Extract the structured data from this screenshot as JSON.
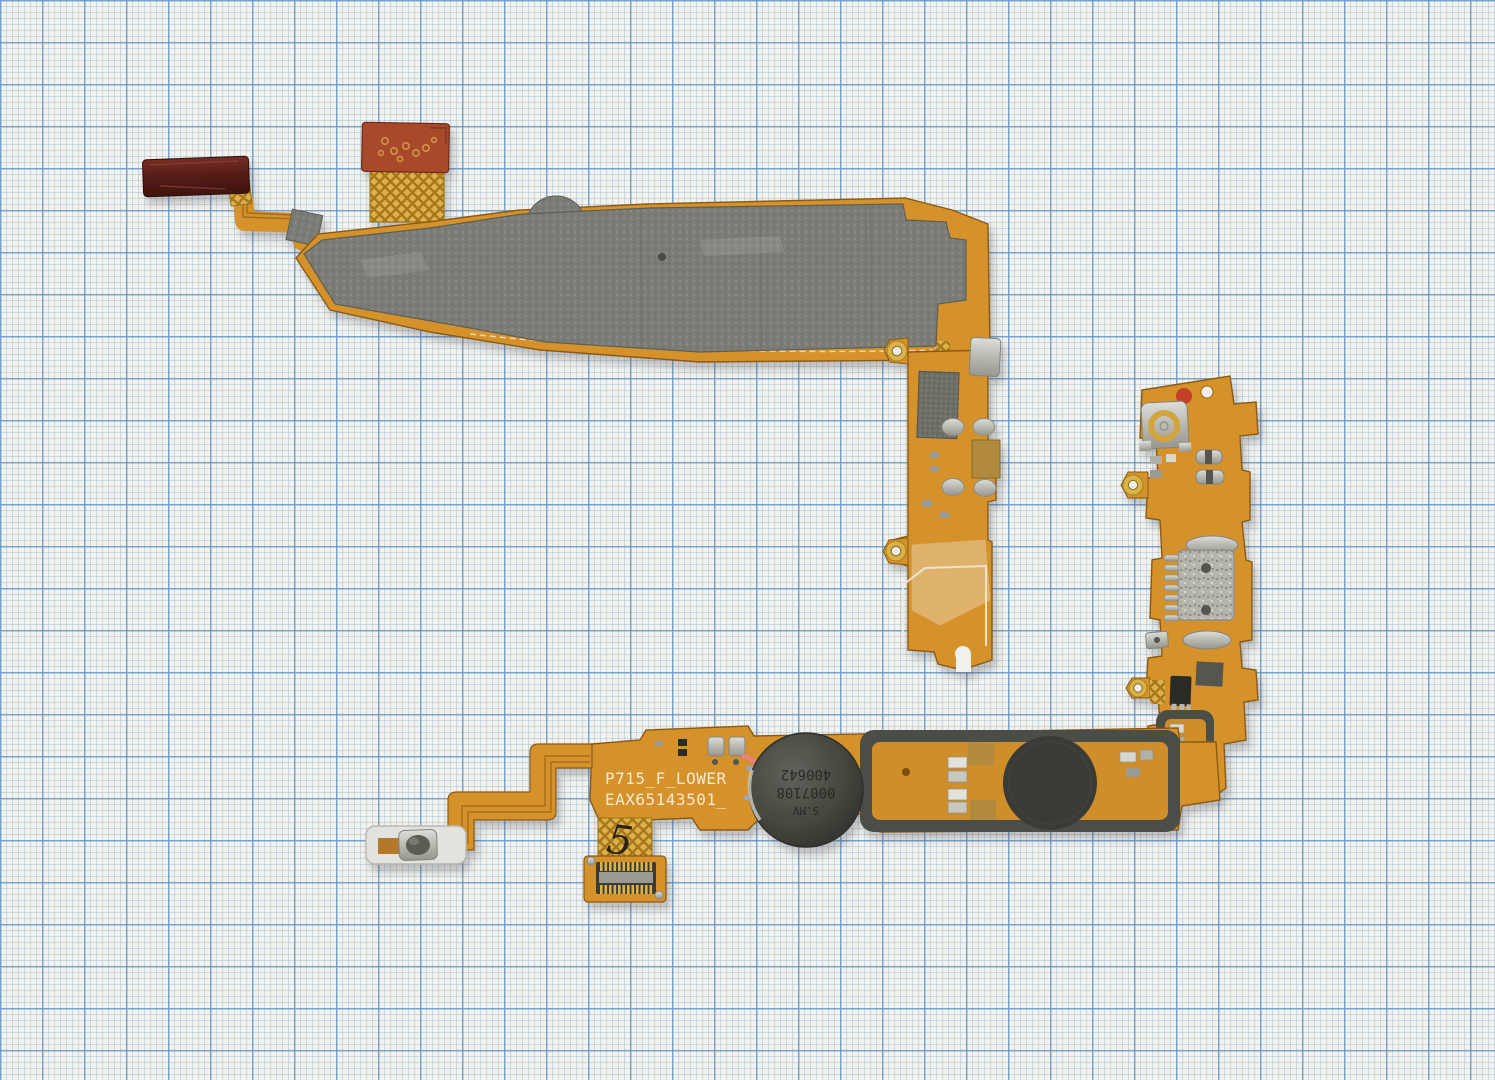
{
  "scene": {
    "background": "millimeter-graph-paper",
    "subject": "phone-lower-flex-cable-assembly-photo"
  },
  "texts": {
    "silkscreen_line1": "P715_F_LOWER",
    "silkscreen_line2": "EAX65143501_",
    "motor_line1": "S.MV",
    "motor_line2": "0007108",
    "motor_line3": "400642",
    "handwritten_mark": "5"
  },
  "parts": [
    "red-adhesive-tape-piece",
    "terracotta-flex-pad",
    "gold-crosshatch-flex",
    "emi-shield-fabric",
    "coax-antenna-connector",
    "micro-usb-connector",
    "vibration-motor",
    "speaker-contact-disc",
    "rubber-gasket-frame",
    "side-key-button-flex",
    "board-to-board-connector",
    "jumper-wires-pink-blue",
    "solder-domes",
    "gold-eyelets"
  ],
  "colors": {
    "paper": "#f4f2ec",
    "grid_minor": "#94b8d6",
    "grid_major": "#6496c6",
    "flex_orange": "#d6922c",
    "flex_dark": "#8a5a12",
    "gold_lattice": "#ddb04a",
    "copper_pad": "#b28a3c",
    "shield_gray": "#7c7d76",
    "maroon_tape": "#5a201a",
    "terracotta_pad": "#a8492a",
    "motor_gray": "#4a4a46",
    "disc_black": "#3a3a36",
    "gasket_gray": "#4c4d46",
    "silver": "#c0c0b9",
    "white_strip": "#e3e3dd",
    "wire_pink": "#e87f90",
    "wire_blue": "#8fa9d6",
    "silkscreen": "#f3ead2",
    "red_paint_dot": "#c23127"
  }
}
